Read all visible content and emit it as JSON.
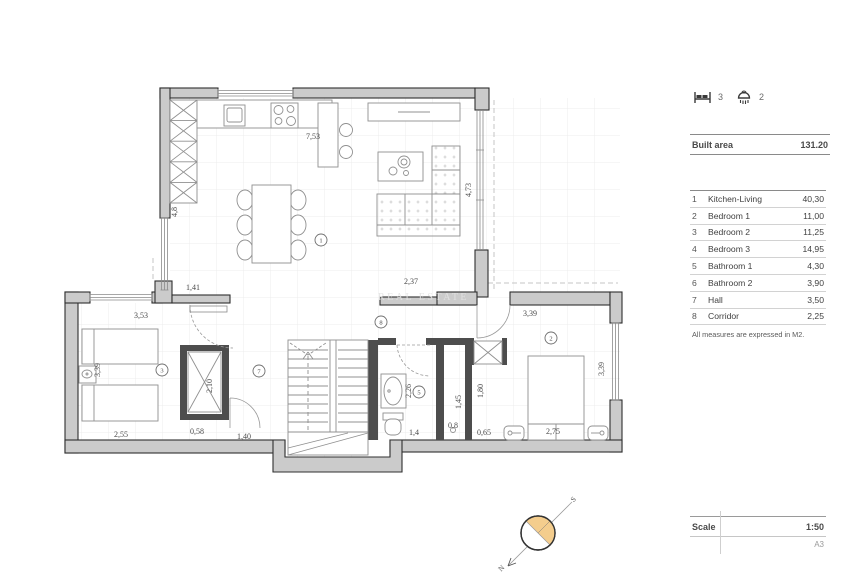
{
  "summary": {
    "bedrooms_icon": "bed-icon",
    "bedrooms_count": "3",
    "bathrooms_icon": "shower-icon",
    "bathrooms_count": "2",
    "built_area_label": "Built area",
    "built_area_value": "131.20"
  },
  "rooms": {
    "rows": [
      {
        "num": "1",
        "name": "Kitchen-Living",
        "area": "40,30"
      },
      {
        "num": "2",
        "name": "Bedroom 1",
        "area": "11,00"
      },
      {
        "num": "3",
        "name": "Bedroom 2",
        "area": "11,25"
      },
      {
        "num": "4",
        "name": "Bedroom 3",
        "area": "14,95"
      },
      {
        "num": "5",
        "name": "Bathroom 1",
        "area": "4,30"
      },
      {
        "num": "6",
        "name": "Bathroom 2",
        "area": "3,90"
      },
      {
        "num": "7",
        "name": "Hall",
        "area": "3,50"
      },
      {
        "num": "8",
        "name": "Corridor",
        "area": "2,25"
      }
    ],
    "note": "All measures are expressed in M2."
  },
  "scale": {
    "label": "Scale",
    "value": "1:50",
    "sheet": "A3"
  },
  "compass": {
    "north_label": "N",
    "south_label": "S"
  },
  "plan": {
    "watermark": "REAL ESTATE",
    "dimensions": [
      {
        "id": "kitchen-width",
        "value": "7,53"
      },
      {
        "id": "kitchen-depth",
        "value": "4,8"
      },
      {
        "id": "living-depth",
        "value": "4,73"
      },
      {
        "id": "corridor-top-wall",
        "value": "2,37"
      },
      {
        "id": "entry-width",
        "value": "1,41"
      },
      {
        "id": "bedroom2-top",
        "value": "3,53"
      },
      {
        "id": "bedroom2-left",
        "value": "3,39"
      },
      {
        "id": "bedroom2-bottom",
        "value": "2,55"
      },
      {
        "id": "closet-gap",
        "value": "0,58"
      },
      {
        "id": "closet-height",
        "value": "2,10"
      },
      {
        "id": "hall-width",
        "value": "1,40"
      },
      {
        "id": "bathroom1-depth",
        "value": "2,26"
      },
      {
        "id": "bathroom1-width",
        "value": "1,4"
      },
      {
        "id": "wc-width",
        "value": "0,8"
      },
      {
        "id": "nook-width",
        "value": "0,65"
      },
      {
        "id": "wc-depth",
        "value": "1,45"
      },
      {
        "id": "nook-depth",
        "value": "1,80"
      },
      {
        "id": "bedroom1-top",
        "value": "3,39"
      },
      {
        "id": "bedroom1-right",
        "value": "3,39"
      },
      {
        "id": "bedroom1-bed",
        "value": "2,75"
      }
    ],
    "markers": [
      {
        "number": "1",
        "room": "kitchen-living"
      },
      {
        "number": "2",
        "room": "bedroom-1"
      },
      {
        "number": "3",
        "room": "bedroom-2"
      },
      {
        "number": "5",
        "room": "bathroom-1"
      },
      {
        "number": "7",
        "room": "hall"
      },
      {
        "number": "8",
        "room": "corridor"
      }
    ],
    "colors": {
      "wall_fill": "#cbcbcb",
      "wall_stroke": "#2f2f2f",
      "partition": "#4d4d4d",
      "furniture_stroke": "#909090",
      "grid": "#ececec",
      "compass_fill": "#f4cd8d",
      "dimension_text": "#4a4a4a",
      "panel_text": "#3c3c3c"
    }
  }
}
